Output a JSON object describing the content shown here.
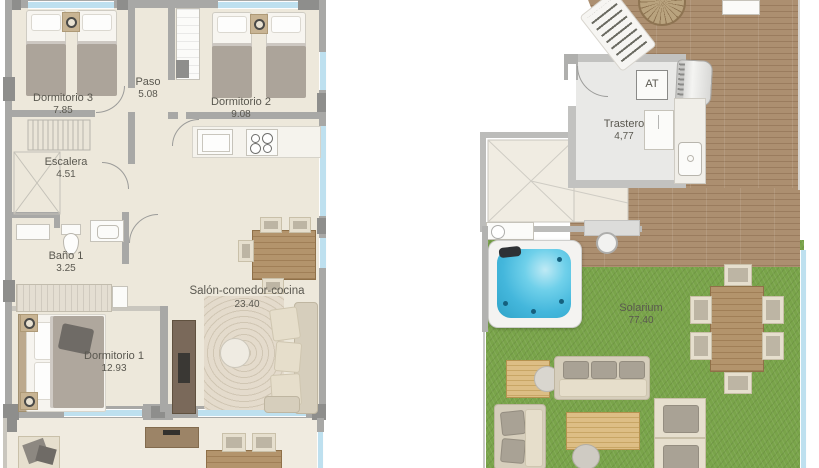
{
  "image": {
    "type": "architectural-floor-plans",
    "views": [
      "main-floor",
      "roof-solarium"
    ]
  },
  "left_plan": {
    "rooms": [
      {
        "name": "Dormitorio 3",
        "area": "7.85"
      },
      {
        "name": "Paso",
        "area": "5.08"
      },
      {
        "name": "Dormitorio 2",
        "area": "9.08"
      },
      {
        "name": "Escalera",
        "area": "4.51"
      },
      {
        "name": "Baño 1",
        "area": "3.25"
      },
      {
        "name": "Dormitorio 1",
        "area": "12.93"
      },
      {
        "name": "Salón-comedor-cocina",
        "area": "23.40"
      }
    ]
  },
  "right_plan": {
    "rooms": [
      {
        "name": "Trastero",
        "area": "4,77"
      },
      {
        "name": "Solarium",
        "area": "77,40"
      }
    ],
    "equipment_label": "AT"
  },
  "colors": {
    "floor": "#EDE8DB",
    "wall": "#A8A8A6",
    "pillar": "#8E8E8C",
    "window_glass": "#BEE0EF",
    "deck_wood": "#A88C6E",
    "grass": "#79A44A",
    "jacuzzi_water": "#4FC0E0",
    "label_text": "#5A5850"
  }
}
